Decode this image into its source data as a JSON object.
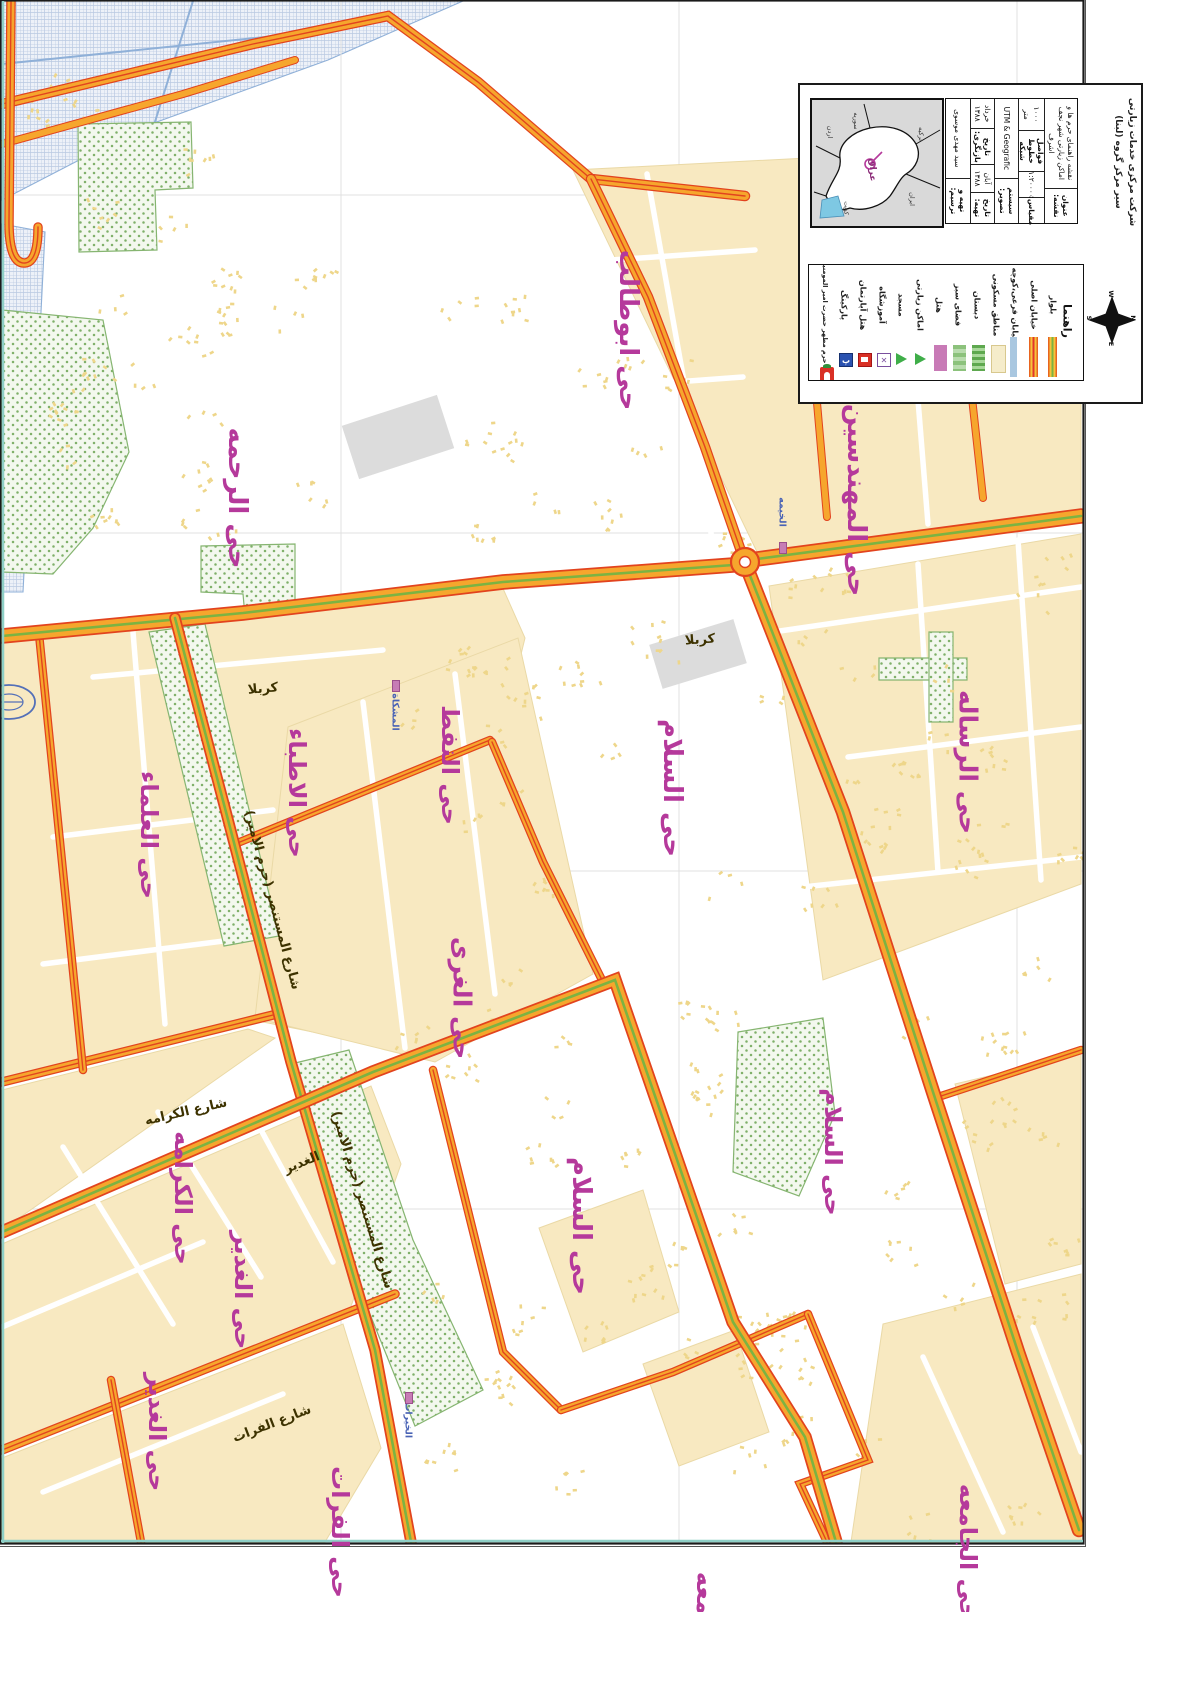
{
  "title_block": {
    "company": {
      "name": "شرکت مرکزی خدمات زیارتی سیر مرکز گروه (لبنا)"
    },
    "inset": {
      "labels": [
        {
          "t": "عراق",
          "x": 60,
          "y": 70,
          "s": 9,
          "bold": true
        },
        {
          "t": "ايران",
          "x": 100,
          "y": 99,
          "s": 6.5
        },
        {
          "t": "تركيه",
          "x": 109,
          "y": 34,
          "s": 6.5
        },
        {
          "t": "سوريه",
          "x": 44,
          "y": 21,
          "s": 6.5
        },
        {
          "t": "اردن",
          "x": 18,
          "y": 32,
          "s": 6.5
        },
        {
          "t": "كويت",
          "x": 34,
          "y": 108,
          "s": 6
        }
      ]
    },
    "table": {
      "rows": [
        {
          "h": 34,
          "cells": [
            {
              "t": "عنوان نقشه:",
              "w": 36,
              "head": true
            },
            {
              "t": "نقشه راهنمای حرم ها و اماکن زیارتی شهر نجف اشرف",
              "w": 90
            }
          ]
        },
        {
          "h": 25,
          "cells": [
            {
              "t": "مقياس:",
              "w": 26,
              "head": true
            },
            {
              "t": "۱:۲۰۰۰۰",
              "w": 26
            },
            {
              "t": "فواصل خطوط شبكه",
              "w": 42,
              "head": true
            },
            {
              "t": "۱۰۰۰ متر",
              "w": 32
            }
          ]
        },
        {
          "h": 24,
          "cells": [
            {
              "t": "سيستم تصوير:",
              "w": 46,
              "head": true
            },
            {
              "t": "UTM & Geografic",
              "w": 80
            }
          ]
        },
        {
          "h": 25,
          "cells": [
            {
              "t": "تاريخ تهيه:",
              "w": 32,
              "head": true
            },
            {
              "t": "آبان ۱۳۸۸",
              "w": 28
            },
            {
              "t": "تاريخ بازنگری:",
              "w": 36,
              "head": true
            },
            {
              "t": "خرداد ۱۳۸۸",
              "w": 30
            }
          ]
        },
        {
          "h": 25,
          "cells": [
            {
              "t": "تهيه و ترسيم:",
              "w": 46,
              "head": true
            },
            {
              "t": "سيد مهدی موسوی",
              "w": 80
            }
          ]
        }
      ]
    },
    "legend": {
      "title": "راهنما",
      "items": [
        {
          "label": "بلوار",
          "icon": "bar-blvd",
          "x": 239
        },
        {
          "label": "خیابان اصلی",
          "icon": "bar-main",
          "x": 220
        },
        {
          "label": "خیابان فرعی،کوچه",
          "icon": "bar-minor",
          "x": 201
        },
        {
          "label": "مناطق مسکونی",
          "icon": "patch-res",
          "x": 182
        },
        {
          "label": "دبستان",
          "icon": "patch-school",
          "x": 163
        },
        {
          "label": "فضای سبز",
          "icon": "patch-green",
          "x": 144
        },
        {
          "label": "هتل",
          "icon": "patch-hotel",
          "x": 125
        },
        {
          "label": "اماکن زیارتی",
          "icon": "arrow",
          "x": 106
        },
        {
          "label": "مسجد",
          "icon": "arrow",
          "x": 87
        },
        {
          "label": "آموزشگاه",
          "icon": "box-x",
          "x": 68
        },
        {
          "label": "هتل آپارتمان",
          "icon": "box-photo",
          "x": 49
        },
        {
          "label": "پارکینگ",
          "icon": "box-p",
          "x": 30
        },
        {
          "label": "حرم مطهر حضرت امير المومنين (ع)",
          "icon": "shrine",
          "x": 11
        }
      ]
    },
    "compass": {
      "letters": [
        {
          "t": "N",
          "x": 46,
          "y": 28
        },
        {
          "t": "E",
          "x": 24,
          "y": 54
        },
        {
          "t": "S",
          "x": 2,
          "y": 28
        },
        {
          "t": "W",
          "x": 24,
          "y": 4
        }
      ]
    }
  },
  "map": {
    "colors": {
      "residential": "#f8e9c1",
      "green_fill": "#f3f8ee",
      "green_dot": "#7fb069",
      "road_fill": "#f6a62d",
      "road_edge": "#e2431e",
      "median": "#7cb342",
      "label_magenta": "#b5399b",
      "label_blue": "#4a63b5",
      "hatch_blue": "#b9c9e2"
    },
    "gridlines": {
      "x": [
        398,
        736,
        1074
      ],
      "y": [
        263,
        601,
        939,
        1277
      ]
    },
    "neighborhoods": [
      {
        "t": "حى الرحمه",
        "x": 237,
        "y": 498,
        "s": 26
      },
      {
        "t": "حى ابوطالب",
        "x": 628,
        "y": 330,
        "s": 26
      },
      {
        "t": "حى المهندسين",
        "x": 856,
        "y": 500,
        "s": 26
      },
      {
        "t": "حى السلام",
        "x": 672,
        "y": 788,
        "s": 26
      },
      {
        "t": "حى الرساله",
        "x": 968,
        "y": 762,
        "s": 25
      },
      {
        "t": "حى النفط",
        "x": 450,
        "y": 765,
        "s": 24
      },
      {
        "t": "حى الاطباء",
        "x": 297,
        "y": 793,
        "s": 24
      },
      {
        "t": "حى العلماء",
        "x": 149,
        "y": 835,
        "s": 24
      },
      {
        "t": "حى الغرى",
        "x": 462,
        "y": 998,
        "s": 25
      },
      {
        "t": "حى الكرامه",
        "x": 183,
        "y": 1198,
        "s": 24
      },
      {
        "t": "حى الغدير",
        "x": 243,
        "y": 1290,
        "s": 24
      },
      {
        "t": "حى الغدير",
        "x": 157,
        "y": 1432,
        "s": 24
      },
      {
        "t": "حى الفرات",
        "x": 340,
        "y": 1532,
        "s": 24
      },
      {
        "t": "حى السلام",
        "x": 581,
        "y": 1226,
        "s": 26
      },
      {
        "t": "حى السلام",
        "x": 833,
        "y": 1152,
        "s": 24
      },
      {
        "t": "حى الجامعه",
        "x": 968,
        "y": 1552,
        "s": 24
      },
      {
        "t": "حى الجامعه",
        "x": 705,
        "y": 1640,
        "s": 24
      }
    ],
    "road_labels": [
      {
        "t": "كربلا",
        "x": 263,
        "y": 689,
        "r": -5
      },
      {
        "t": "كربلا",
        "x": 700,
        "y": 640,
        "r": -4
      },
      {
        "t": "شارع الكرامه",
        "x": 186,
        "y": 1112,
        "r": -13
      },
      {
        "t": "الغدير",
        "x": 302,
        "y": 1163,
        "r": -22
      },
      {
        "t": "شارع الفرات",
        "x": 272,
        "y": 1424,
        "r": -21
      },
      {
        "t": "شارع المستنصر (حرم الامير)",
        "x": 272,
        "y": 900,
        "r": 75
      },
      {
        "t": "شارع المستنصر (حرم الامير)",
        "x": 362,
        "y": 1200,
        "r": 73
      }
    ],
    "landmarks": [
      {
        "t": "الخيمه",
        "x": 782,
        "y": 512,
        "dy": 30
      },
      {
        "t": "المشكاة",
        "x": 395,
        "y": 712,
        "dy": -32
      },
      {
        "t": "الخيرات",
        "x": 408,
        "y": 1420,
        "dy": -28
      }
    ],
    "roads": [
      {
        "id": "tl-blvd",
        "type": "main",
        "w": 8,
        "d": "M59,172 L310,112 L445,84 L535,150 L648,247 L802,264"
      },
      {
        "id": "tl-upper",
        "type": "minor",
        "w": 6,
        "d": "M59,212 L240,162 L352,128"
      },
      {
        "id": "left-vert",
        "type": "main",
        "w": 7,
        "d": "M68,70 L66,290 Q66,332 82,331 Q95,330 95,295"
      },
      {
        "id": "mohandesin-west",
        "type": "main",
        "w": 8,
        "d": "M648,247 L705,365 L762,515 L799,622"
      },
      {
        "id": "karbala-w",
        "type": "blvd",
        "w": 12,
        "d": "M59,704 L300,681 L560,650 L790,633"
      },
      {
        "id": "karbala-e",
        "type": "blvd",
        "w": 12,
        "d": "M814,627 L1138,584"
      },
      {
        "id": "se-blvd",
        "type": "blvd",
        "w": 11,
        "d": "M806,641 L900,880 L990,1160 L1075,1420 L1136,1598"
      },
      {
        "id": "mustansar",
        "type": "blvd",
        "w": 8,
        "d": "M232,686 L283,880 L348,1130 L432,1418 L468,1610"
      },
      {
        "id": "karama",
        "type": "main",
        "w": 7,
        "d": "M59,1150 L330,1083"
      },
      {
        "id": "ghadir",
        "type": "blvd",
        "w": 10,
        "d": "M59,1300 L430,1140 L672,1048 L790,1390 L862,1505 L893,1610"
      },
      {
        "id": "furat",
        "type": "main",
        "w": 7,
        "d": "M59,1518 L260,1438 L452,1362"
      },
      {
        "id": "s1",
        "type": "main",
        "w": 6,
        "d": "M96,702 L140,1138"
      },
      {
        "id": "c1",
        "type": "main",
        "w": 6,
        "d": "M292,912 L547,808"
      },
      {
        "id": "s2",
        "type": "main",
        "w": 6,
        "d": "M549,810 L600,930 L660,1050"
      },
      {
        "id": "s3",
        "type": "main",
        "w": 6,
        "d": "M490,1138 L560,1420 L618,1478"
      },
      {
        "id": "j1",
        "type": "main",
        "w": 6,
        "d": "M618,1478 L730,1440 L865,1382"
      },
      {
        "id": "j2",
        "type": "main",
        "w": 6,
        "d": "M865,1382 L925,1528 L857,1552 L884,1610"
      },
      {
        "id": "v1",
        "type": "minor",
        "w": 6,
        "d": "M884,585 L868,402"
      },
      {
        "id": "v2",
        "type": "minor",
        "w": 6,
        "d": "M1040,566 L1022,402"
      },
      {
        "id": "bl-vert",
        "type": "main",
        "w": 6,
        "d": "M168,1448 L198,1610"
      },
      {
        "id": "rb",
        "type": "main",
        "w": 6,
        "d": "M992,1166 L1138,1118"
      }
    ],
    "roundabout": {
      "x": 802,
      "y": 630
    },
    "residential_areas": [
      "630,238 1138,212 1138,580 815,622",
      "826,654 1138,602 1138,952 880,1048",
      "1012,1152 1138,1122 1138,1332 1062,1352",
      "59,708 300,683 558,652 582,706 480,1122 310,1088 59,1148",
      "345,795 575,706 650,1042 492,1130 312,1086",
      "59,1158 305,1097 332,1106 59,1298",
      "59,1312 428,1154 458,1232 406,1380 262,1436 59,1514",
      "59,1526 400,1392 438,1516 382,1610 59,1610",
      "940,1392 1138,1342 1138,1610 908,1610",
      "596,1296 700,1258 736,1380 640,1420",
      "700,1432 792,1398 826,1500 736,1534"
    ],
    "green_areas": [
      "135,192 248,190 250,256 212,258 214,318 136,320",
      "59,378 160,388 186,520 150,596 110,642 59,640",
      "258,614 352,612 352,680 302,684 300,662 258,660",
      "206,700 262,692 336,1004 281,1014",
      "348,1132 406,1118 470,1308 540,1458 472,1494 406,1330",
      "795,1100 880,1086 892,1182 856,1264 790,1240",
      "936,726 1024,726 1024,748 936,748",
      "986,700 1010,700 1010,790 986,790"
    ],
    "farm_areas": [
      "59,69 520,69 385,128 200,195 59,268",
      "59,292 102,300 96,420 59,428",
      "59,540 86,544 80,660 59,660"
    ],
    "gray_buildings": [
      {
        "x": 455,
        "y": 505,
        "w": 100,
        "h": 56,
        "r": -18
      },
      {
        "x": 755,
        "y": 722,
        "w": 88,
        "h": 46,
        "r": -17
      }
    ],
    "white_streets": [
      "M704,242 L770,612",
      "M955,220 L985,592",
      "M640,330 L812,318",
      "M665,455 L800,445",
      "M830,700 L1138,655",
      "M905,825 L1138,795",
      "M860,955 L1138,925",
      "M1075,608 L1098,948",
      "M975,632 L995,940",
      "M150,745 L440,718",
      "M110,905 L330,878",
      "M100,1032 L320,1004",
      "M190,700 L222,1092",
      "M420,770 L462,1116",
      "M512,742 L552,1062",
      "M120,1215 L230,1392",
      "M215,1180 L318,1345",
      "M59,1395 L260,1310",
      "M300,1165 L390,1330",
      "M100,1560 L340,1462",
      "M980,1425 L1060,1600",
      "M1090,1395 L1138,1520"
    ],
    "farm_roads": [
      "M59,132 L390,98",
      "M250,69 L210,196"
    ],
    "scatter_zones": [
      {
        "x": 90,
        "y": 140,
        "w": 330,
        "h": 470,
        "n": 26
      },
      {
        "x": 430,
        "y": 330,
        "w": 370,
        "h": 290,
        "n": 12
      },
      {
        "x": 445,
        "y": 690,
        "w": 355,
        "h": 650,
        "n": 30
      },
      {
        "x": 830,
        "y": 615,
        "w": 300,
        "h": 445,
        "n": 20
      },
      {
        "x": 430,
        "y": 1350,
        "w": 690,
        "h": 250,
        "n": 22
      },
      {
        "x": 950,
        "y": 1060,
        "w": 185,
        "h": 285,
        "n": 9
      }
    ],
    "stadium": {
      "x": 66,
      "y": 770
    }
  }
}
